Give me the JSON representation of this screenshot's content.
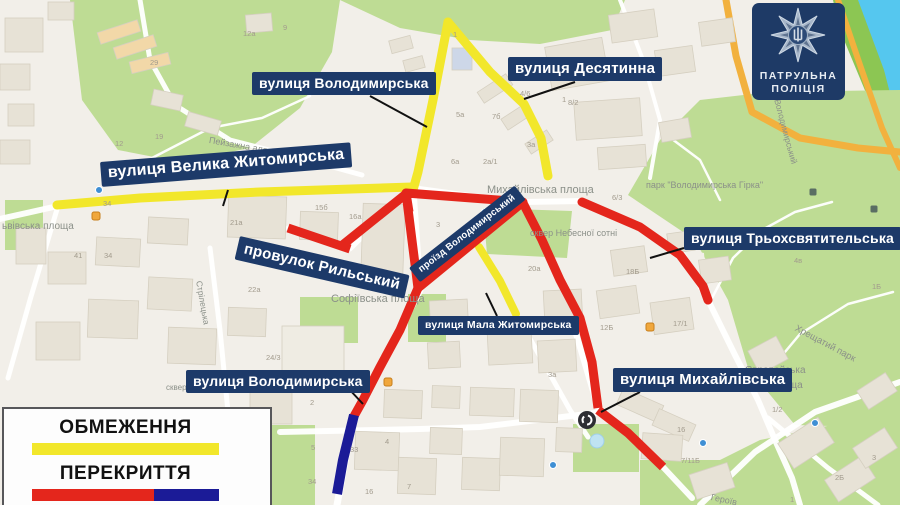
{
  "badge": {
    "line1": "ПАТРУЛЬНА",
    "line2": "ПОЛІЦІЯ"
  },
  "legend": {
    "items": [
      {
        "label": "ОБМЕЖЕННЯ",
        "type": "restriction"
      },
      {
        "label": "ПЕРЕКРИТТЯ",
        "type": "closure"
      }
    ]
  },
  "colors": {
    "restriction_yellow": "#f2e72b",
    "closure_red": "#e4261c",
    "closure_blue": "#1b1b97",
    "callout_bg": "#1d3a69",
    "badge_bg": "#1e3a66"
  },
  "callouts": [
    {
      "id": "volodymyrska-top",
      "text": "вулиця Володимирська",
      "x": 252,
      "y": 72,
      "fs": 14,
      "rot": 0,
      "pointer": [
        370,
        96,
        427,
        127
      ]
    },
    {
      "id": "desyatynna",
      "text": "вулиця Десятинна",
      "x": 508,
      "y": 57,
      "fs": 15,
      "rot": 0,
      "pointer": [
        575,
        82,
        524,
        99
      ]
    },
    {
      "id": "velyka-zhytomyrska",
      "text": "вулиця Велика Житомирська",
      "x": 100,
      "y": 162,
      "fs": 16,
      "rot": -4.5,
      "pointer": [
        228,
        190,
        223,
        206
      ]
    },
    {
      "id": "rylskyi",
      "text": "провулок Рильський",
      "x": 240,
      "y": 236,
      "fs": 15,
      "rot": 13,
      "pointer": null
    },
    {
      "id": "proizd-volodymyrskyi",
      "text": "проїзд Володимирський",
      "x": 409,
      "y": 268,
      "fs": 9.5,
      "rot": -38,
      "pointer": null
    },
    {
      "id": "tryokhsviatytelska",
      "text": "вулиця Трьохсвятительська",
      "x": 684,
      "y": 227,
      "fs": 14,
      "rot": 0,
      "pointer": [
        684,
        248,
        650,
        258
      ]
    },
    {
      "id": "mala-zhytomyrska",
      "text": "вулиця Мала Житомирська",
      "x": 418,
      "y": 316,
      "fs": 10.5,
      "rot": 0,
      "pointer": [
        497,
        316,
        486,
        293
      ]
    },
    {
      "id": "volodymyrska-bottom",
      "text": "вулиця Володимирська",
      "x": 186,
      "y": 370,
      "fs": 14,
      "rot": 0,
      "pointer": [
        348,
        388,
        363,
        404
      ]
    },
    {
      "id": "mykhailivska",
      "text": "вулиця Михайлівська",
      "x": 613,
      "y": 368,
      "fs": 15,
      "rot": 0,
      "pointer": [
        640,
        392,
        601,
        412
      ]
    }
  ],
  "routes": [
    {
      "name": "route-velyka-zhytomyrska",
      "color": "#f2e72b",
      "width": 9,
      "cap": "round",
      "points": [
        [
          57,
          205
        ],
        [
          140,
          198
        ],
        [
          260,
          192
        ],
        [
          412,
          187
        ]
      ]
    },
    {
      "name": "route-volodymyrska-north",
      "color": "#f2e72b",
      "width": 9,
      "cap": "round",
      "points": [
        [
          448,
          22
        ],
        [
          433,
          100
        ],
        [
          418,
          172
        ],
        [
          413,
          190
        ]
      ]
    },
    {
      "name": "route-desyatynna",
      "color": "#f2e72b",
      "width": 9,
      "cap": "round",
      "points": [
        [
          448,
          22
        ],
        [
          490,
          72
        ],
        [
          524,
          104
        ],
        [
          541,
          138
        ],
        [
          548,
          176
        ]
      ]
    },
    {
      "name": "route-mala-zhytomyrska",
      "color": "#f2e72b",
      "width": 8,
      "cap": "round",
      "points": [
        [
          479,
          247
        ],
        [
          500,
          281
        ],
        [
          516,
          314
        ]
      ]
    },
    {
      "name": "route-rylskyi",
      "color": "#e4261c",
      "width": 9,
      "cap": "butt",
      "points": [
        [
          288,
          228
        ],
        [
          350,
          249
        ]
      ]
    },
    {
      "name": "route-sofiivska-link",
      "color": "#e4261c",
      "width": 9,
      "cap": "butt",
      "points": [
        [
          340,
          247
        ],
        [
          406,
          194
        ]
      ]
    },
    {
      "name": "route-mykhailivska-square-loop",
      "color": "#e4261c",
      "width": 9,
      "cap": "butt",
      "points": [
        [
          406,
          193
        ],
        [
          523,
          202
        ],
        [
          418,
          288
        ],
        [
          406,
          193
        ],
        [
          409,
          212
        ]
      ]
    },
    {
      "name": "route-volodymyrska-mid",
      "color": "#e4261c",
      "width": 9,
      "cap": "butt",
      "points": [
        [
          418,
          288
        ],
        [
          400,
          330
        ],
        [
          380,
          367
        ],
        [
          363,
          400
        ],
        [
          353,
          418
        ]
      ]
    },
    {
      "name": "route-volodymyrskyi-descent",
      "color": "#e4261c",
      "width": 9,
      "cap": "butt",
      "points": [
        [
          523,
          203
        ],
        [
          542,
          240
        ],
        [
          560,
          280
        ],
        [
          580,
          318
        ],
        [
          592,
          362
        ],
        [
          598,
          408
        ]
      ]
    },
    {
      "name": "route-mykhailivska-branch",
      "color": "#e4261c",
      "width": 9,
      "cap": "butt",
      "points": [
        [
          598,
          410
        ],
        [
          628,
          433
        ],
        [
          663,
          467
        ]
      ]
    },
    {
      "name": "route-tryokhsviatytelska",
      "color": "#e4261c",
      "width": 9,
      "cap": "round",
      "points": [
        [
          582,
          202
        ],
        [
          640,
          227
        ],
        [
          680,
          255
        ],
        [
          703,
          286
        ],
        [
          708,
          300
        ]
      ]
    },
    {
      "name": "route-volodymyrska-south-closed",
      "color": "#1b1b97",
      "width": 10,
      "cap": "butt",
      "points": [
        [
          354,
          415
        ],
        [
          343,
          460
        ],
        [
          337,
          494
        ]
      ]
    }
  ],
  "map_labels": [
    {
      "text": "ьвівська площа",
      "x": 2,
      "y": 221,
      "fs": 10,
      "rot": 0
    },
    {
      "text": "Пейзажна алея",
      "x": 210,
      "y": 135,
      "fs": 9,
      "rot": 10
    },
    {
      "text": "Михайлівська площа",
      "x": 487,
      "y": 184,
      "fs": 11,
      "rot": 0
    },
    {
      "text": "сквер Небесної сотні",
      "x": 530,
      "y": 228,
      "fs": 9,
      "rot": 0
    },
    {
      "text": "парк \"Володимирська Гірка\"",
      "x": 646,
      "y": 180,
      "fs": 9,
      "rot": 0
    },
    {
      "text": "Софіївська площа",
      "x": 331,
      "y": 293,
      "fs": 11,
      "rot": 0
    },
    {
      "text": "сквер ім. Павла Шеремета",
      "x": 166,
      "y": 383,
      "fs": 8,
      "rot": 0
    },
    {
      "text": "Хрещатий парк",
      "x": 798,
      "y": 323,
      "fs": 9.5,
      "rot": 28
    },
    {
      "text": "Європейська",
      "x": 745,
      "y": 365,
      "fs": 10,
      "rot": 0
    },
    {
      "text": "площа",
      "x": 772,
      "y": 380,
      "fs": 10,
      "rot": 0
    },
    {
      "text": "Володимирський",
      "x": 782,
      "y": 98,
      "fs": 8.5,
      "rot": 75
    },
    {
      "text": "Стрілецька",
      "x": 204,
      "y": 280,
      "fs": 8.5,
      "rot": 80
    },
    {
      "text": "Героїв",
      "x": 712,
      "y": 492,
      "fs": 9,
      "rot": 12
    }
  ],
  "building_numbers": [
    {
      "t": "29",
      "x": 150,
      "y": 58
    },
    {
      "t": "12а",
      "x": 243,
      "y": 29
    },
    {
      "t": "9",
      "x": 283,
      "y": 23
    },
    {
      "t": "19",
      "x": 155,
      "y": 132
    },
    {
      "t": "12",
      "x": 115,
      "y": 139
    },
    {
      "t": "41",
      "x": 74,
      "y": 251
    },
    {
      "t": "34",
      "x": 104,
      "y": 251
    },
    {
      "t": "34",
      "x": 103,
      "y": 199
    },
    {
      "t": "15б",
      "x": 315,
      "y": 203
    },
    {
      "t": "16а",
      "x": 349,
      "y": 212
    },
    {
      "t": "21а",
      "x": 230,
      "y": 218
    },
    {
      "t": "22а",
      "x": 248,
      "y": 285
    },
    {
      "t": "3",
      "x": 436,
      "y": 220
    },
    {
      "t": "1",
      "x": 453,
      "y": 30
    },
    {
      "t": "5а",
      "x": 456,
      "y": 110
    },
    {
      "t": "7б",
      "x": 492,
      "y": 112
    },
    {
      "t": "3а",
      "x": 527,
      "y": 140
    },
    {
      "t": "1",
      "x": 562,
      "y": 95
    },
    {
      "t": "2а/1",
      "x": 483,
      "y": 157
    },
    {
      "t": "6а",
      "x": 451,
      "y": 157
    },
    {
      "t": "4/6",
      "x": 520,
      "y": 89
    },
    {
      "t": "8/2",
      "x": 568,
      "y": 98
    },
    {
      "t": "6/3",
      "x": 612,
      "y": 193
    },
    {
      "t": "4в",
      "x": 794,
      "y": 256
    },
    {
      "t": "1Б",
      "x": 872,
      "y": 282
    },
    {
      "t": "17/1",
      "x": 673,
      "y": 319
    },
    {
      "t": "18Б",
      "x": 626,
      "y": 267
    },
    {
      "t": "12Б",
      "x": 600,
      "y": 323
    },
    {
      "t": "3а",
      "x": 548,
      "y": 370
    },
    {
      "t": "10в",
      "x": 691,
      "y": 383
    },
    {
      "t": "1/2",
      "x": 772,
      "y": 405
    },
    {
      "t": "24/3",
      "x": 266,
      "y": 353
    },
    {
      "t": "2",
      "x": 310,
      "y": 398
    },
    {
      "t": "5",
      "x": 311,
      "y": 443
    },
    {
      "t": "33",
      "x": 350,
      "y": 445
    },
    {
      "t": "4",
      "x": 385,
      "y": 437
    },
    {
      "t": "34",
      "x": 308,
      "y": 477
    },
    {
      "t": "16",
      "x": 365,
      "y": 487
    },
    {
      "t": "7",
      "x": 407,
      "y": 482
    },
    {
      "t": "16",
      "x": 677,
      "y": 425
    },
    {
      "t": "7/11Б",
      "x": 681,
      "y": 456
    },
    {
      "t": "2Б",
      "x": 835,
      "y": 473
    },
    {
      "t": "3",
      "x": 872,
      "y": 453
    },
    {
      "t": "1",
      "x": 790,
      "y": 495
    },
    {
      "t": "20а",
      "x": 528,
      "y": 264
    }
  ]
}
